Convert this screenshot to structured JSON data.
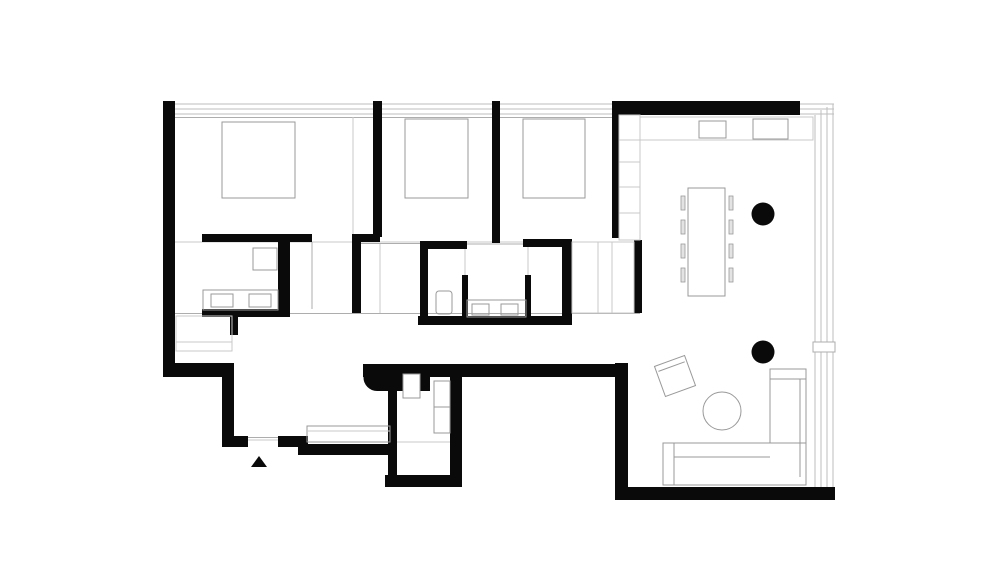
{
  "canvas": {
    "width": 1000,
    "height": 573,
    "background": "#ffffff"
  },
  "colors": {
    "wall": "#0a0a0a",
    "furn": "#999999",
    "lite": "#c9c9c9",
    "mid": "#adadad",
    "win": "#bdbdbd",
    "chair": "#e3e3e3",
    "white": "#ffffff"
  },
  "plan": {
    "kind": "apartment-floor-plan",
    "rooms_depicted": [
      "bedroom-1",
      "bedroom-2",
      "bedroom-3",
      "bathroom-1",
      "bathroom-2",
      "entry",
      "wc-laundry",
      "corridor",
      "living-dining-kitchen"
    ]
  },
  "elements": [
    {
      "t": "line",
      "n": "window-band-top-1",
      "x1": 175,
      "y1": 104,
      "x2": 612,
      "y2": 104,
      "s": "win"
    },
    {
      "t": "line",
      "n": "window-band-top-2",
      "x1": 175,
      "y1": 109,
      "x2": 612,
      "y2": 109,
      "s": "win"
    },
    {
      "t": "line",
      "n": "window-band-top-3",
      "x1": 175,
      "y1": 114,
      "x2": 612,
      "y2": 114,
      "s": "win"
    },
    {
      "t": "line",
      "n": "window-sill-top",
      "x1": 175,
      "y1": 117.5,
      "x2": 612,
      "y2": 117.5,
      "s": "mid"
    },
    {
      "t": "line",
      "n": "window-band-topright-1",
      "x1": 800,
      "y1": 104,
      "x2": 834,
      "y2": 104,
      "s": "win"
    },
    {
      "t": "line",
      "n": "window-band-topright-2",
      "x1": 800,
      "y1": 109,
      "x2": 834,
      "y2": 109,
      "s": "win"
    },
    {
      "t": "line",
      "n": "window-band-topright-3",
      "x1": 800,
      "y1": 114,
      "x2": 834,
      "y2": 114,
      "s": "win"
    },
    {
      "t": "line",
      "n": "window-facade-right-1",
      "x1": 815,
      "y1": 115,
      "x2": 815,
      "y2": 490,
      "s": "win"
    },
    {
      "t": "line",
      "n": "window-facade-right-2",
      "x1": 821,
      "y1": 110,
      "x2": 821,
      "y2": 490,
      "s": "win"
    },
    {
      "t": "line",
      "n": "window-facade-right-3",
      "x1": 827,
      "y1": 107,
      "x2": 827,
      "y2": 490,
      "s": "win"
    },
    {
      "t": "line",
      "n": "window-facade-right-4",
      "x1": 833,
      "y1": 104,
      "x2": 833,
      "y2": 490,
      "s": "win"
    },
    {
      "t": "line",
      "n": "zone-line-bedrooms",
      "x1": 175,
      "y1": 242,
      "x2": 613,
      "y2": 242,
      "s": "lite"
    },
    {
      "t": "line",
      "n": "zone-line-corridor",
      "x1": 175,
      "y1": 313.5,
      "x2": 640,
      "y2": 313.5,
      "s": "mid"
    },
    {
      "t": "line",
      "n": "wardrobe-line-bedroom1",
      "x1": 353,
      "y1": 117,
      "x2": 353,
      "y2": 237,
      "s": "lite"
    },
    {
      "t": "line",
      "n": "shower-line-bath1",
      "x1": 312,
      "y1": 242,
      "x2": 312,
      "y2": 309,
      "s": "mid"
    },
    {
      "t": "line",
      "n": "partition-line-bedroom2",
      "x1": 380,
      "y1": 243,
      "x2": 380,
      "y2": 313,
      "s": "lite"
    },
    {
      "t": "line",
      "n": "threshold-bath1",
      "x1": 360,
      "y1": 243.5,
      "x2": 420,
      "y2": 243.5,
      "s": "mid"
    },
    {
      "t": "line",
      "n": "threshold-bath2",
      "x1": 467,
      "y1": 244,
      "x2": 527,
      "y2": 244,
      "s": "mid"
    },
    {
      "t": "line",
      "n": "bath2-glass-left",
      "x1": 465,
      "y1": 249,
      "x2": 465,
      "y2": 275,
      "s": "lite"
    },
    {
      "t": "line",
      "n": "bath2-glass-right",
      "x1": 528,
      "y1": 247,
      "x2": 528,
      "y2": 275,
      "s": "lite"
    },
    {
      "t": "line",
      "n": "entry-door-threshold-1",
      "x1": 248,
      "y1": 437.5,
      "x2": 278,
      "y2": 437.5,
      "s": "mid"
    },
    {
      "t": "line",
      "n": "entry-door-threshold-2",
      "x1": 248,
      "y1": 440,
      "x2": 278,
      "y2": 440,
      "s": "lite"
    },
    {
      "t": "line",
      "n": "wc-floor-line",
      "x1": 397,
      "y1": 442,
      "x2": 450,
      "y2": 442,
      "s": "lite"
    },
    {
      "t": "rect",
      "n": "wall-left-exterior",
      "x": 163,
      "y": 101,
      "w": 12,
      "h": 276,
      "f": "wall"
    },
    {
      "t": "rect",
      "n": "wall-bed1-bed2",
      "x": 373,
      "y": 101,
      "w": 9,
      "h": 136,
      "f": "wall"
    },
    {
      "t": "rect",
      "n": "wall-bed2-bed3",
      "x": 492,
      "y": 101,
      "w": 8,
      "h": 142,
      "f": "wall"
    },
    {
      "t": "rect",
      "n": "wall-top-right",
      "x": 612,
      "y": 101,
      "w": 188,
      "h": 14,
      "f": "wall"
    },
    {
      "t": "rect",
      "n": "wall-bed3-living-upper",
      "x": 612,
      "y": 115,
      "w": 7,
      "h": 123,
      "f": "wall"
    },
    {
      "t": "rect",
      "n": "wall-bed3-closet",
      "x": 634,
      "y": 240,
      "w": 8,
      "h": 73,
      "f": "wall"
    },
    {
      "t": "rect",
      "n": "wall-bath1-top",
      "x": 202,
      "y": 234,
      "w": 110,
      "h": 8,
      "f": "wall"
    },
    {
      "t": "rect",
      "n": "wall-bath1-arm",
      "x": 352,
      "y": 234,
      "w": 28,
      "h": 8,
      "f": "wall"
    },
    {
      "t": "rect",
      "n": "wall-bath1-right",
      "x": 352,
      "y": 234,
      "w": 9,
      "h": 79,
      "f": "wall"
    },
    {
      "t": "rect",
      "n": "wall-bath1-mid",
      "x": 278,
      "y": 242,
      "w": 12,
      "h": 71,
      "f": "wall"
    },
    {
      "t": "rect",
      "n": "wall-bath1-bottom",
      "x": 202,
      "y": 309,
      "w": 88,
      "h": 8,
      "f": "wall"
    },
    {
      "t": "rect",
      "n": "wall-bath1-stub",
      "x": 230,
      "y": 317,
      "w": 8,
      "h": 18,
      "f": "wall"
    },
    {
      "t": "rect",
      "n": "wall-bath2-left",
      "x": 420,
      "y": 241,
      "w": 8,
      "h": 83,
      "f": "wall"
    },
    {
      "t": "rect",
      "n": "wall-bath2-arm-left",
      "x": 420,
      "y": 241,
      "w": 47,
      "h": 8,
      "f": "wall"
    },
    {
      "t": "rect",
      "n": "wall-bath2-arm-right",
      "x": 523,
      "y": 239,
      "w": 49,
      "h": 8,
      "f": "wall"
    },
    {
      "t": "rect",
      "n": "wall-bath2-right",
      "x": 562,
      "y": 239,
      "w": 10,
      "h": 85,
      "f": "wall"
    },
    {
      "t": "rect",
      "n": "wall-bath2-bottom",
      "x": 418,
      "y": 316,
      "w": 154,
      "h": 9,
      "f": "wall"
    },
    {
      "t": "rect",
      "n": "wall-bath2-partition-left",
      "x": 462,
      "y": 275,
      "w": 6,
      "h": 42,
      "f": "wall"
    },
    {
      "t": "rect",
      "n": "wall-bath2-partition-right",
      "x": 525,
      "y": 275,
      "w": 6,
      "h": 42,
      "f": "wall"
    },
    {
      "t": "rect",
      "n": "wall-entry-north",
      "x": 163,
      "y": 363,
      "w": 71,
      "h": 14,
      "f": "wall"
    },
    {
      "t": "rect",
      "n": "wall-entry-west",
      "x": 222,
      "y": 377,
      "w": 12,
      "h": 70,
      "f": "wall"
    },
    {
      "t": "rect",
      "n": "wall-entry-south-left",
      "x": 222,
      "y": 436,
      "w": 26,
      "h": 11,
      "f": "wall"
    },
    {
      "t": "rect",
      "n": "wall-entry-south-right",
      "x": 278,
      "y": 436,
      "w": 30,
      "h": 11,
      "f": "wall"
    },
    {
      "t": "rect",
      "n": "wall-entry-step",
      "x": 298,
      "y": 444,
      "w": 94,
      "h": 11,
      "f": "wall"
    },
    {
      "t": "rect",
      "n": "wall-corridor-south",
      "x": 363,
      "y": 364,
      "w": 265,
      "h": 13,
      "f": "wall"
    },
    {
      "t": "circle",
      "n": "wall-bullnose-end",
      "cx": 377,
      "cy": 377.5,
      "r": 13.5,
      "f": "wall"
    },
    {
      "t": "rect",
      "n": "wall-bullnose-body",
      "x": 377,
      "y": 364,
      "w": 44,
      "h": 27,
      "f": "wall"
    },
    {
      "t": "rect",
      "n": "wall-wc-nib",
      "x": 419,
      "y": 374,
      "w": 11,
      "h": 17,
      "f": "wall"
    },
    {
      "t": "rect",
      "n": "wall-wc-left",
      "x": 388,
      "y": 390,
      "w": 9,
      "h": 87,
      "f": "wall"
    },
    {
      "t": "rect",
      "n": "wall-wc-bottom",
      "x": 385,
      "y": 475,
      "w": 77,
      "h": 12,
      "f": "wall"
    },
    {
      "t": "rect",
      "n": "wall-wc-right",
      "x": 450,
      "y": 377,
      "w": 12,
      "h": 110,
      "f": "wall"
    },
    {
      "t": "rect",
      "n": "wall-living-west-lower",
      "x": 615,
      "y": 363,
      "w": 13,
      "h": 124,
      "f": "wall"
    },
    {
      "t": "rect",
      "n": "wall-bottom-exterior",
      "x": 615,
      "y": 487,
      "w": 220,
      "h": 13,
      "f": "wall"
    },
    {
      "t": "poly",
      "n": "entry-arrow",
      "points": "259,456 251,467 267,467",
      "f": "wall"
    },
    {
      "t": "circle",
      "n": "column-1",
      "cx": 763,
      "cy": 214,
      "r": 11.5,
      "f": "wall"
    },
    {
      "t": "circle",
      "n": "column-2",
      "cx": 763,
      "cy": 352,
      "r": 11.5,
      "f": "wall"
    },
    {
      "t": "rect",
      "n": "bed-1",
      "x": 222,
      "y": 122,
      "w": 73,
      "h": 76,
      "s": "furn"
    },
    {
      "t": "rect",
      "n": "bed-2",
      "x": 405,
      "y": 119,
      "w": 63,
      "h": 79,
      "s": "furn"
    },
    {
      "t": "rect",
      "n": "bed-3",
      "x": 523,
      "y": 119,
      "w": 62,
      "h": 79,
      "s": "furn"
    },
    {
      "t": "rect",
      "n": "bath1-toilet",
      "x": 253,
      "y": 248,
      "w": 24,
      "h": 22,
      "s": "furn"
    },
    {
      "t": "rect",
      "n": "bath1-vanity",
      "x": 203,
      "y": 290,
      "w": 75,
      "h": 20,
      "s": "furn"
    },
    {
      "t": "rect",
      "n": "bath1-sink-1",
      "x": 211,
      "y": 294,
      "w": 22,
      "h": 13,
      "s": "furn"
    },
    {
      "t": "rect",
      "n": "bath1-sink-2",
      "x": 249,
      "y": 294,
      "w": 22,
      "h": 13,
      "s": "furn"
    },
    {
      "t": "rect",
      "n": "bedroom1-closet",
      "x": 176,
      "y": 316,
      "w": 56,
      "h": 35,
      "s": "lite"
    },
    {
      "t": "line",
      "n": "bedroom1-closet-shelf",
      "x1": 176,
      "y1": 342,
      "x2": 232,
      "y2": 342,
      "s": "lite"
    },
    {
      "t": "rect",
      "n": "bath2-toilet",
      "x": 436,
      "y": 291,
      "w": 16,
      "h": 23,
      "rx": 3,
      "s": "furn"
    },
    {
      "t": "rect",
      "n": "bath2-vanity",
      "x": 467,
      "y": 300,
      "w": 59,
      "h": 17,
      "s": "furn"
    },
    {
      "t": "rect",
      "n": "bath2-sink-1",
      "x": 472,
      "y": 304,
      "w": 17,
      "h": 11,
      "s": "furn"
    },
    {
      "t": "rect",
      "n": "bath2-sink-2",
      "x": 501,
      "y": 304,
      "w": 17,
      "h": 11,
      "s": "furn"
    },
    {
      "t": "rect",
      "n": "bedroom3-closet",
      "x": 572,
      "y": 242,
      "w": 62,
      "h": 71,
      "s": "lite"
    },
    {
      "t": "line",
      "n": "bedroom3-closet-div-1",
      "x1": 598,
      "y1": 242,
      "x2": 598,
      "y2": 313,
      "s": "lite"
    },
    {
      "t": "line",
      "n": "bedroom3-closet-div-2",
      "x1": 612,
      "y1": 242,
      "x2": 612,
      "y2": 313,
      "s": "lite"
    },
    {
      "t": "rect",
      "n": "living-tall-cabinet",
      "x": 619,
      "y": 115,
      "w": 21,
      "h": 125,
      "s": "lite"
    },
    {
      "t": "line",
      "n": "cabinet-shelf-1",
      "x1": 619,
      "y1": 140,
      "x2": 640,
      "y2": 140,
      "s": "lite"
    },
    {
      "t": "line",
      "n": "cabinet-shelf-2",
      "x1": 619,
      "y1": 162,
      "x2": 640,
      "y2": 162,
      "s": "lite"
    },
    {
      "t": "line",
      "n": "cabinet-shelf-3",
      "x1": 619,
      "y1": 187,
      "x2": 640,
      "y2": 187,
      "s": "lite"
    },
    {
      "t": "line",
      "n": "cabinet-shelf-4",
      "x1": 619,
      "y1": 213,
      "x2": 640,
      "y2": 213,
      "s": "lite"
    },
    {
      "t": "rect",
      "n": "kitchen-counter",
      "x": 640,
      "y": 117,
      "w": 173,
      "h": 23,
      "s": "lite"
    },
    {
      "t": "rect",
      "n": "kitchen-sink",
      "x": 699,
      "y": 121,
      "w": 27,
      "h": 17,
      "s": "furn"
    },
    {
      "t": "rect",
      "n": "kitchen-cooktop",
      "x": 753,
      "y": 119,
      "w": 35,
      "h": 20,
      "s": "furn"
    },
    {
      "t": "rect",
      "n": "dining-table",
      "x": 688,
      "y": 188,
      "w": 37,
      "h": 108,
      "s": "furn"
    },
    {
      "t": "rect",
      "n": "dining-chair-l1",
      "x": 681,
      "y": 196,
      "w": 4,
      "h": 14,
      "f": "chair",
      "s": "furn",
      "sw": 0.8
    },
    {
      "t": "rect",
      "n": "dining-chair-l2",
      "x": 681,
      "y": 220,
      "w": 4,
      "h": 14,
      "f": "chair",
      "s": "furn",
      "sw": 0.8
    },
    {
      "t": "rect",
      "n": "dining-chair-l3",
      "x": 681,
      "y": 244,
      "w": 4,
      "h": 14,
      "f": "chair",
      "s": "furn",
      "sw": 0.8
    },
    {
      "t": "rect",
      "n": "dining-chair-l4",
      "x": 681,
      "y": 268,
      "w": 4,
      "h": 14,
      "f": "chair",
      "s": "furn",
      "sw": 0.8
    },
    {
      "t": "rect",
      "n": "dining-chair-r1",
      "x": 729,
      "y": 196,
      "w": 4,
      "h": 14,
      "f": "chair",
      "s": "furn",
      "sw": 0.8
    },
    {
      "t": "rect",
      "n": "dining-chair-r2",
      "x": 729,
      "y": 220,
      "w": 4,
      "h": 14,
      "f": "chair",
      "s": "furn",
      "sw": 0.8
    },
    {
      "t": "rect",
      "n": "dining-chair-r3",
      "x": 729,
      "y": 244,
      "w": 4,
      "h": 14,
      "f": "chair",
      "s": "furn",
      "sw": 0.8
    },
    {
      "t": "rect",
      "n": "dining-chair-r4",
      "x": 729,
      "y": 268,
      "w": 4,
      "h": 14,
      "f": "chair",
      "s": "furn",
      "sw": 0.8
    },
    {
      "t": "rect",
      "n": "armchair",
      "x": 659,
      "y": 360,
      "w": 32,
      "h": 32,
      "s": "furn",
      "f": "white",
      "tr": "rotate(-20 675 376)"
    },
    {
      "t": "line",
      "n": "armchair-backrest",
      "x1": 661,
      "y1": 366,
      "x2": 689,
      "y2": 366,
      "s": "furn",
      "tr": "rotate(-20 675 376)"
    },
    {
      "t": "circle",
      "n": "coffee-table",
      "cx": 722,
      "cy": 411,
      "r": 19,
      "s": "furn",
      "f": "white"
    },
    {
      "t": "rect",
      "n": "sofa-chaise",
      "x": 770,
      "y": 369,
      "w": 36,
      "h": 116,
      "s": "furn",
      "f": "white"
    },
    {
      "t": "rect",
      "n": "sofa-seat",
      "x": 663,
      "y": 443,
      "w": 143,
      "h": 42,
      "s": "furn",
      "f": "white"
    },
    {
      "t": "line",
      "n": "sofa-arm-line",
      "x1": 674,
      "y1": 443,
      "x2": 674,
      "y2": 485,
      "s": "furn"
    },
    {
      "t": "line",
      "n": "sofa-seat-line",
      "x1": 674,
      "y1": 457,
      "x2": 770,
      "y2": 457,
      "s": "furn"
    },
    {
      "t": "line",
      "n": "sofa-back-line",
      "x1": 800,
      "y1": 379,
      "x2": 800,
      "y2": 477,
      "s": "furn"
    },
    {
      "t": "line",
      "n": "sofa-cap-line",
      "x1": 770,
      "y1": 379,
      "x2": 806,
      "y2": 379,
      "s": "furn"
    },
    {
      "t": "rect",
      "n": "entry-bench",
      "x": 307,
      "y": 426,
      "w": 83,
      "h": 16,
      "s": "furn"
    },
    {
      "t": "line",
      "n": "entry-bench-line",
      "x1": 307,
      "y1": 431,
      "x2": 390,
      "y2": 431,
      "s": "lite"
    },
    {
      "t": "rect",
      "n": "wc-washer-1",
      "x": 434,
      "y": 381,
      "w": 16,
      "h": 26,
      "s": "furn",
      "f": "white"
    },
    {
      "t": "rect",
      "n": "wc-washer-2",
      "x": 434,
      "y": 407,
      "w": 16,
      "h": 26,
      "s": "furn",
      "f": "white"
    },
    {
      "t": "rect",
      "n": "wc-toilet",
      "x": 403,
      "y": 374,
      "w": 17,
      "h": 24,
      "s": "furn",
      "f": "white"
    },
    {
      "t": "rect",
      "n": "window-mullion-tick",
      "x": 813,
      "y": 342,
      "w": 22,
      "h": 10,
      "s": "mid",
      "f": "white"
    }
  ]
}
